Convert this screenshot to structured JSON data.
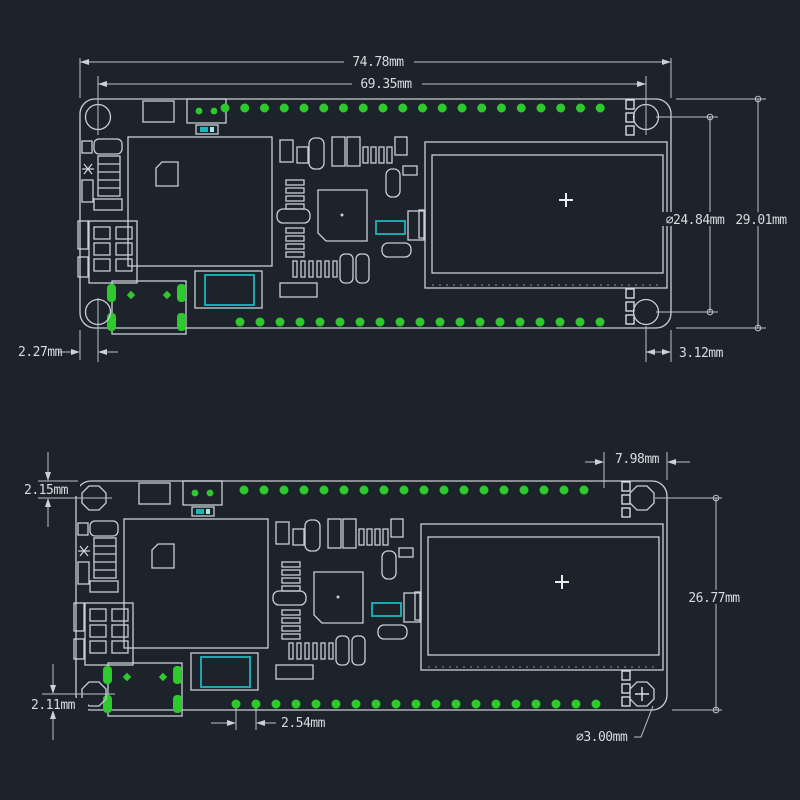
{
  "drawing": {
    "type": "pcb-mechanical-dimension-drawing",
    "views": [
      "top-board-view",
      "bottom-board-view"
    ]
  },
  "colors": {
    "background": "#1d232b",
    "outline": "#c9cfd4",
    "dimension": "#b9c1c8",
    "text": "#d6dbdf",
    "pad_green": "#2dc92d",
    "accent_teal": "#1db4bc"
  },
  "views": {
    "top": {
      "labels": {
        "overall_width": "74.78mm",
        "hole_span_width": "69.35mm",
        "hole_span_height": "⌀24.84mm",
        "overall_height": "29.01mm",
        "left_hole_offset": "2.27mm",
        "right_hole_offset": "3.12mm"
      }
    },
    "bottom": {
      "labels": {
        "right_pin_offset": "7.98mm",
        "top_pin_offset": "2.15mm",
        "pin_to_bottom_height": "26.77mm",
        "bottom_pin_offset": "2.11mm",
        "pin_pitch": "2.54mm",
        "hole_diameter": "⌀3.00mm"
      }
    }
  }
}
